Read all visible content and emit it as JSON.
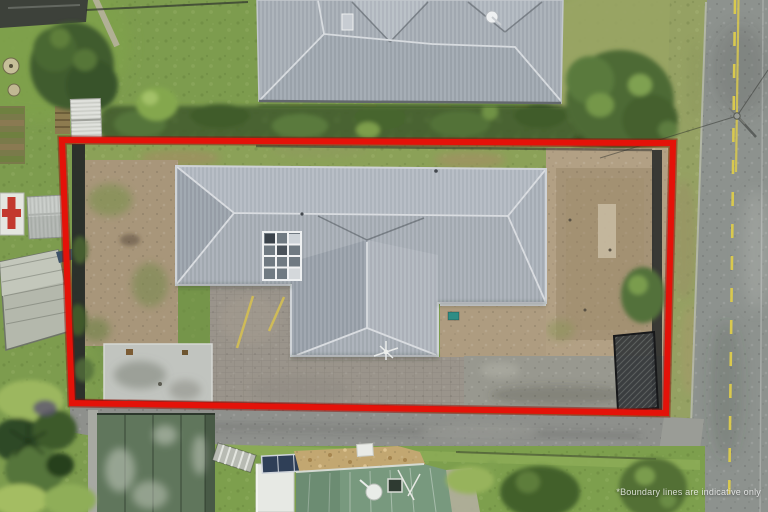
{
  "image": {
    "kind": "aerial-drone-photograph",
    "subject": "residential property viewed from above with red boundary overlay"
  },
  "boundary": {
    "disclaimer": "*Boundary lines are indicative only",
    "color": "#e41209",
    "halo_color": "#8e0f07",
    "points": "62,140 673,143 666,413 72,403"
  },
  "colors": {
    "grass": "#7d9c4e",
    "grass_dry": "#9aa565",
    "roof_gray": "#a6adb5",
    "roof_ridge": "#d7dbdf",
    "dirt": "#b2a084",
    "asphalt": "#8e908c",
    "concrete_pad": "#c1c4bf",
    "hedge": "#486430",
    "road": "#8d928e",
    "road_marking_yellow": "#d9c94e",
    "garage_roof_green": "#60765c",
    "cottage_roof_green": "#78997e",
    "solar_panel": "#2f3f57",
    "stone_roof": "#c2a771",
    "fence_dark": "#282b29"
  }
}
